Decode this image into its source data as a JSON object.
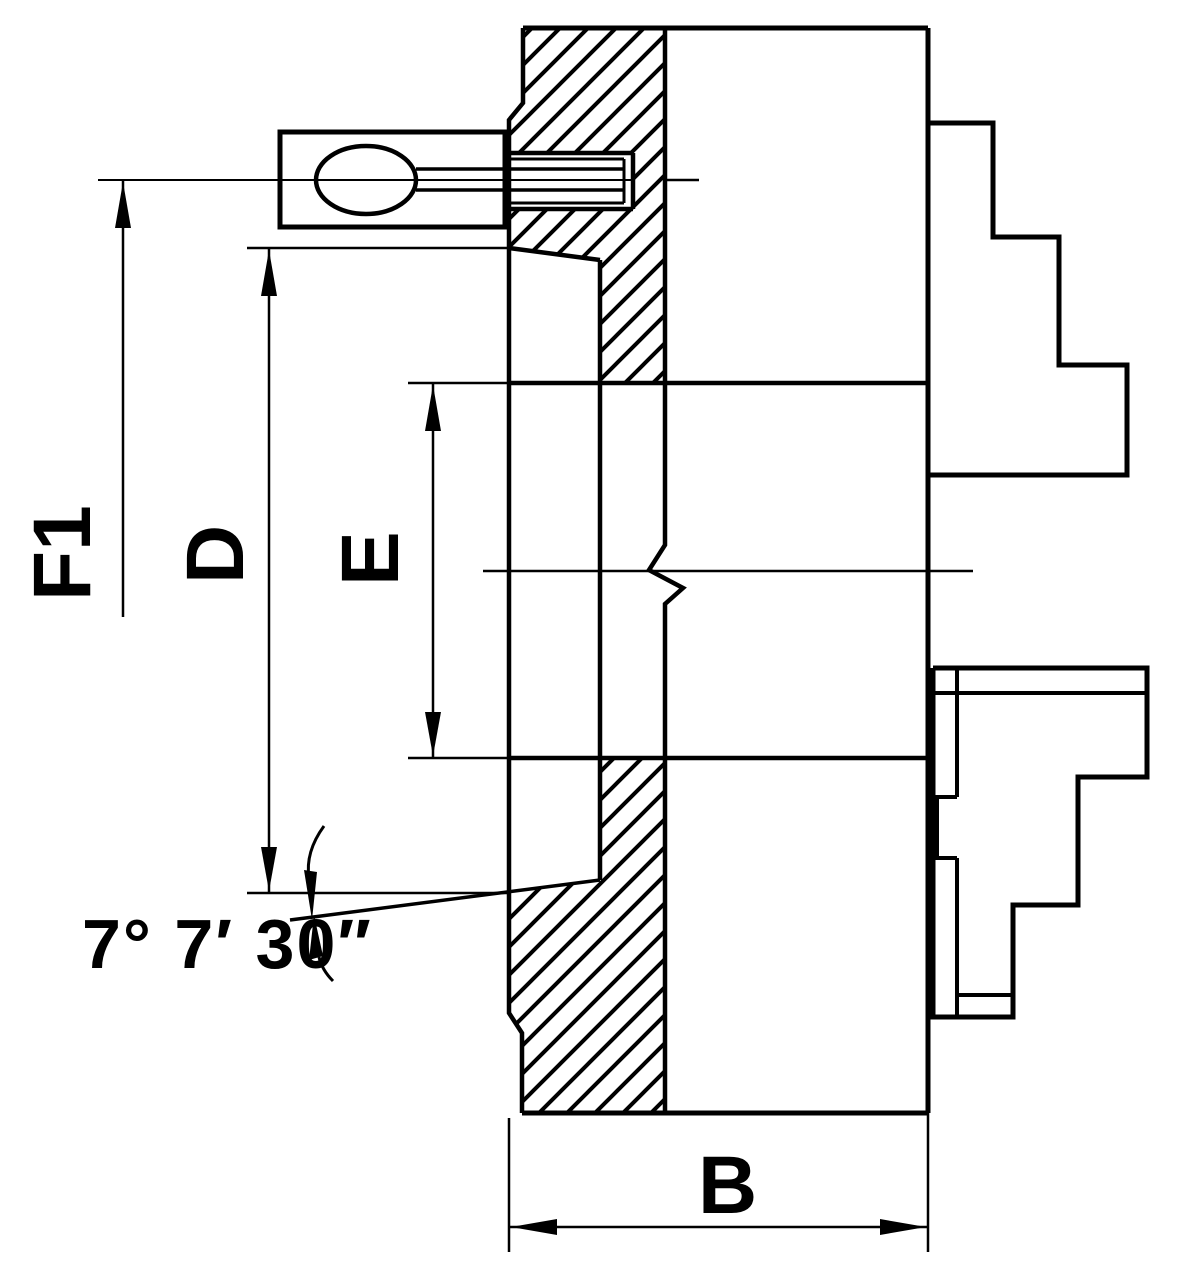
{
  "drawing": {
    "type": "engineering-section-drawing",
    "subject": "lathe chuck cross-section with stepped jaws and tapered mounting recess",
    "colors": {
      "line": "#000000",
      "background": "#ffffff"
    },
    "dimensions": {
      "f1": {
        "label": "F1"
      },
      "d": {
        "label": "D"
      },
      "e": {
        "label": "E"
      },
      "b": {
        "label": "B"
      },
      "taper_angle": {
        "label": "7° 7′ 30″"
      }
    }
  }
}
